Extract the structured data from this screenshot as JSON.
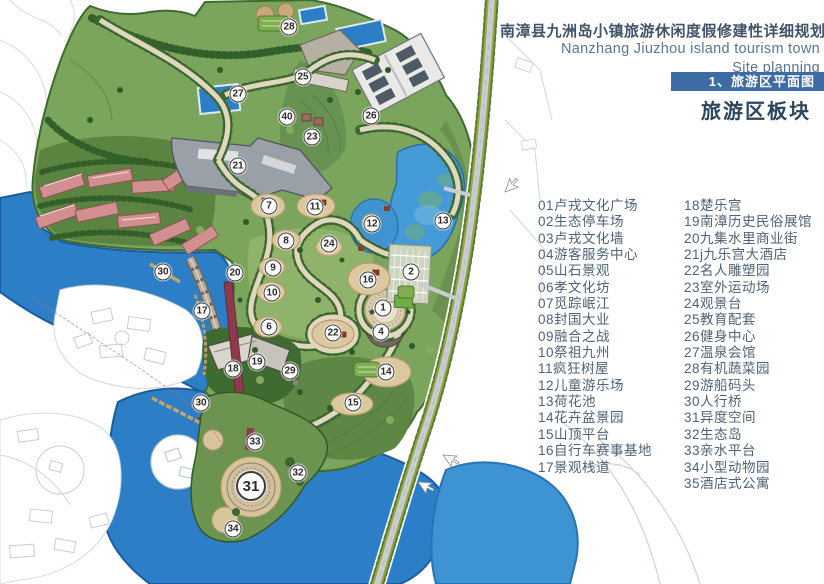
{
  "header": {
    "title_zh": "南漳县九洲岛小镇旅游休闲度假修建性详细规划",
    "title_en_1": "Nanzhang Jiuzhou island tourism town",
    "title_en_2": "Site planning",
    "section_tab": "1、旅游区平面图",
    "section_heading": "旅游区板块"
  },
  "colors": {
    "tab_background": "#3c6ca3",
    "title_text": "#42546a",
    "legend_text": "#4d6379",
    "lake_blue": "#2c7fc7",
    "pond_blue": "#459bd6",
    "land_green": "#7ba45c",
    "road_gray": "#c9cdd1",
    "red_roof": "#d08e8f",
    "bridge_maroon": "#8c3a4c"
  },
  "legend": {
    "column1": [
      {
        "num": "01",
        "label": "卢戎文化广场"
      },
      {
        "num": "02",
        "label": "生态停车场"
      },
      {
        "num": "03",
        "label": "卢戎文化墙"
      },
      {
        "num": "04",
        "label": "游客服务中心"
      },
      {
        "num": "05",
        "label": "山石景观"
      },
      {
        "num": "06",
        "label": "孝文化坊"
      },
      {
        "num": "07",
        "label": "觅踪岷江"
      },
      {
        "num": "08",
        "label": "封国大业"
      },
      {
        "num": "09",
        "label": "融合之战"
      },
      {
        "num": "10",
        "label": "祭祖九州"
      },
      {
        "num": "11",
        "label": "疯狂树屋"
      },
      {
        "num": "12",
        "label": "儿童游乐场"
      },
      {
        "num": "13",
        "label": "荷花池"
      },
      {
        "num": "14",
        "label": "花卉盆景园"
      },
      {
        "num": "15",
        "label": "山顶平台"
      },
      {
        "num": "16",
        "label": "自行车赛事基地"
      },
      {
        "num": "17",
        "label": "景观栈道"
      }
    ],
    "column2": [
      {
        "num": "18",
        "label": "楚乐宫"
      },
      {
        "num": "19",
        "label": "南漳历史民俗展馆"
      },
      {
        "num": "20",
        "label": "九集水里商业街"
      },
      {
        "num": "21",
        "label": "j九乐宫大酒店"
      },
      {
        "num": "22",
        "label": "名人雕塑园"
      },
      {
        "num": "23",
        "label": "室外运动场"
      },
      {
        "num": "24",
        "label": "观景台"
      },
      {
        "num": "25",
        "label": "教育配套"
      },
      {
        "num": "26",
        "label": "健身中心"
      },
      {
        "num": "27",
        "label": "温泉会馆"
      },
      {
        "num": "28",
        "label": "有机蔬菜园"
      },
      {
        "num": "29",
        "label": "游船码头"
      },
      {
        "num": "30",
        "label": "人行桥"
      },
      {
        "num": "31",
        "label": "异度空间"
      },
      {
        "num": "32",
        "label": "生态岛"
      },
      {
        "num": "33",
        "label": "亲水平台"
      },
      {
        "num": "34",
        "label": "小型动物园"
      },
      {
        "num": "35",
        "label": "酒店式公寓"
      }
    ]
  },
  "map": {
    "markers": [
      {
        "n": "28",
        "x": 289,
        "y": 27
      },
      {
        "n": "25",
        "x": 303,
        "y": 77
      },
      {
        "n": "27",
        "x": 238,
        "y": 94
      },
      {
        "n": "40",
        "x": 287,
        "y": 117
      },
      {
        "n": "23",
        "x": 312,
        "y": 137
      },
      {
        "n": "26",
        "x": 371,
        "y": 116
      },
      {
        "n": "21",
        "x": 238,
        "y": 166
      },
      {
        "n": "7",
        "x": 269,
        "y": 206
      },
      {
        "n": "11",
        "x": 315,
        "y": 207
      },
      {
        "n": "12",
        "x": 372,
        "y": 224
      },
      {
        "n": "13",
        "x": 443,
        "y": 221
      },
      {
        "n": "2",
        "x": 411,
        "y": 272
      },
      {
        "n": "8",
        "x": 286,
        "y": 241
      },
      {
        "n": "24",
        "x": 329,
        "y": 244
      },
      {
        "n": "9",
        "x": 273,
        "y": 268
      },
      {
        "n": "20",
        "x": 235,
        "y": 273
      },
      {
        "n": "10",
        "x": 272,
        "y": 293
      },
      {
        "n": "16",
        "x": 368,
        "y": 280
      },
      {
        "n": "1",
        "x": 383,
        "y": 308
      },
      {
        "n": "4",
        "x": 381,
        "y": 332
      },
      {
        "n": "6",
        "x": 269,
        "y": 327
      },
      {
        "n": "17",
        "x": 202,
        "y": 311
      },
      {
        "n": "22",
        "x": 333,
        "y": 333
      },
      {
        "n": "19",
        "x": 257,
        "y": 362
      },
      {
        "n": "18",
        "x": 233,
        "y": 369
      },
      {
        "n": "29",
        "x": 290,
        "y": 371
      },
      {
        "n": "14",
        "x": 386,
        "y": 372
      },
      {
        "n": "15",
        "x": 353,
        "y": 403
      },
      {
        "n": "30",
        "x": 163,
        "y": 272
      },
      {
        "n": "30",
        "x": 201,
        "y": 403
      },
      {
        "n": "33",
        "x": 255,
        "y": 442
      },
      {
        "n": "31",
        "x": 251,
        "y": 486,
        "large": true
      },
      {
        "n": "32",
        "x": 298,
        "y": 473
      },
      {
        "n": "34",
        "x": 233,
        "y": 529
      }
    ]
  }
}
